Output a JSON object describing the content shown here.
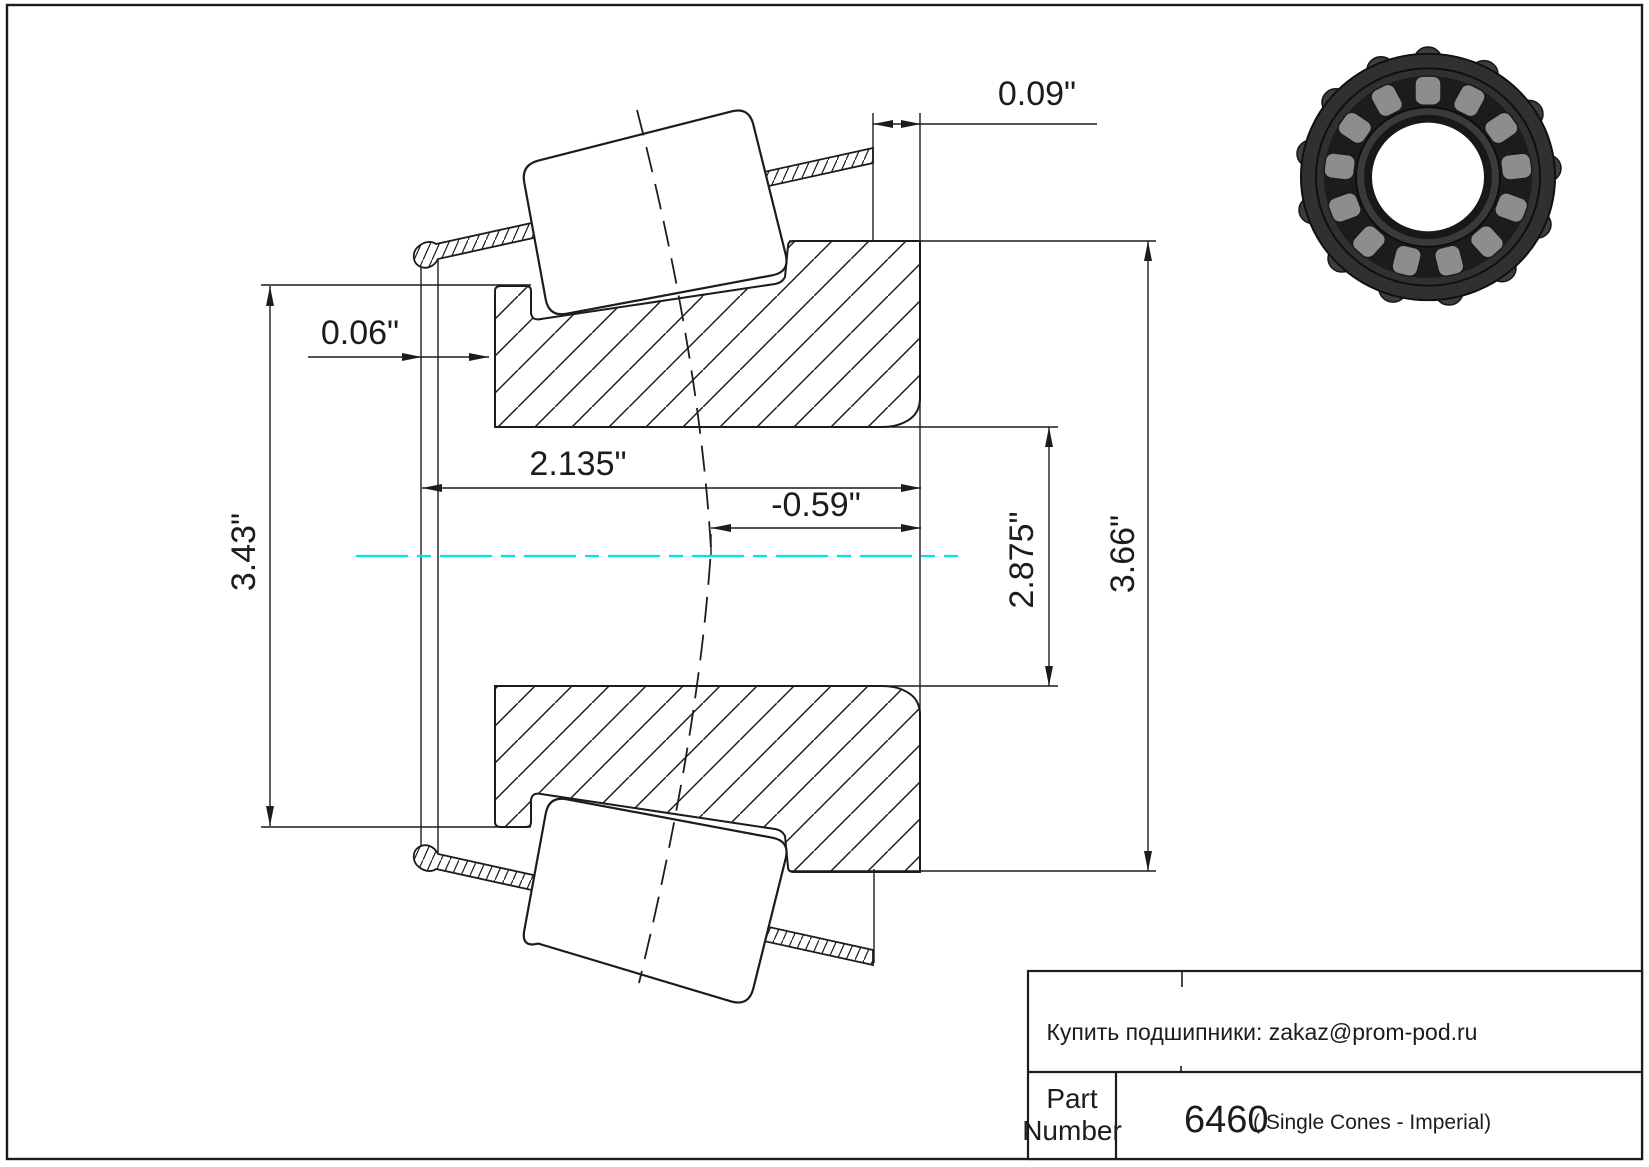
{
  "drawing": {
    "dimensions": {
      "cage_back_offset": "0.09\"",
      "cage_front_offset": "0.06\"",
      "cone_width": "2.135\"",
      "effective_center": "-0.59\"",
      "bore_diameter": "2.875\"",
      "outer_diameter": "3.66\"",
      "cage_diameter": "3.43\""
    }
  },
  "title_block": {
    "contact_line": "Купить подшипники: zakaz@prom-pod.ru",
    "part_label_line1": "Part",
    "part_label_line2": "Number",
    "part_number": "6460",
    "series_note": "( Single Cones - Imperial)"
  },
  "colors": {
    "centerline": "#00e6e6",
    "ink": "#1c1c1c"
  },
  "icons": {
    "photo": "tapered-roller-bearing-photo"
  }
}
